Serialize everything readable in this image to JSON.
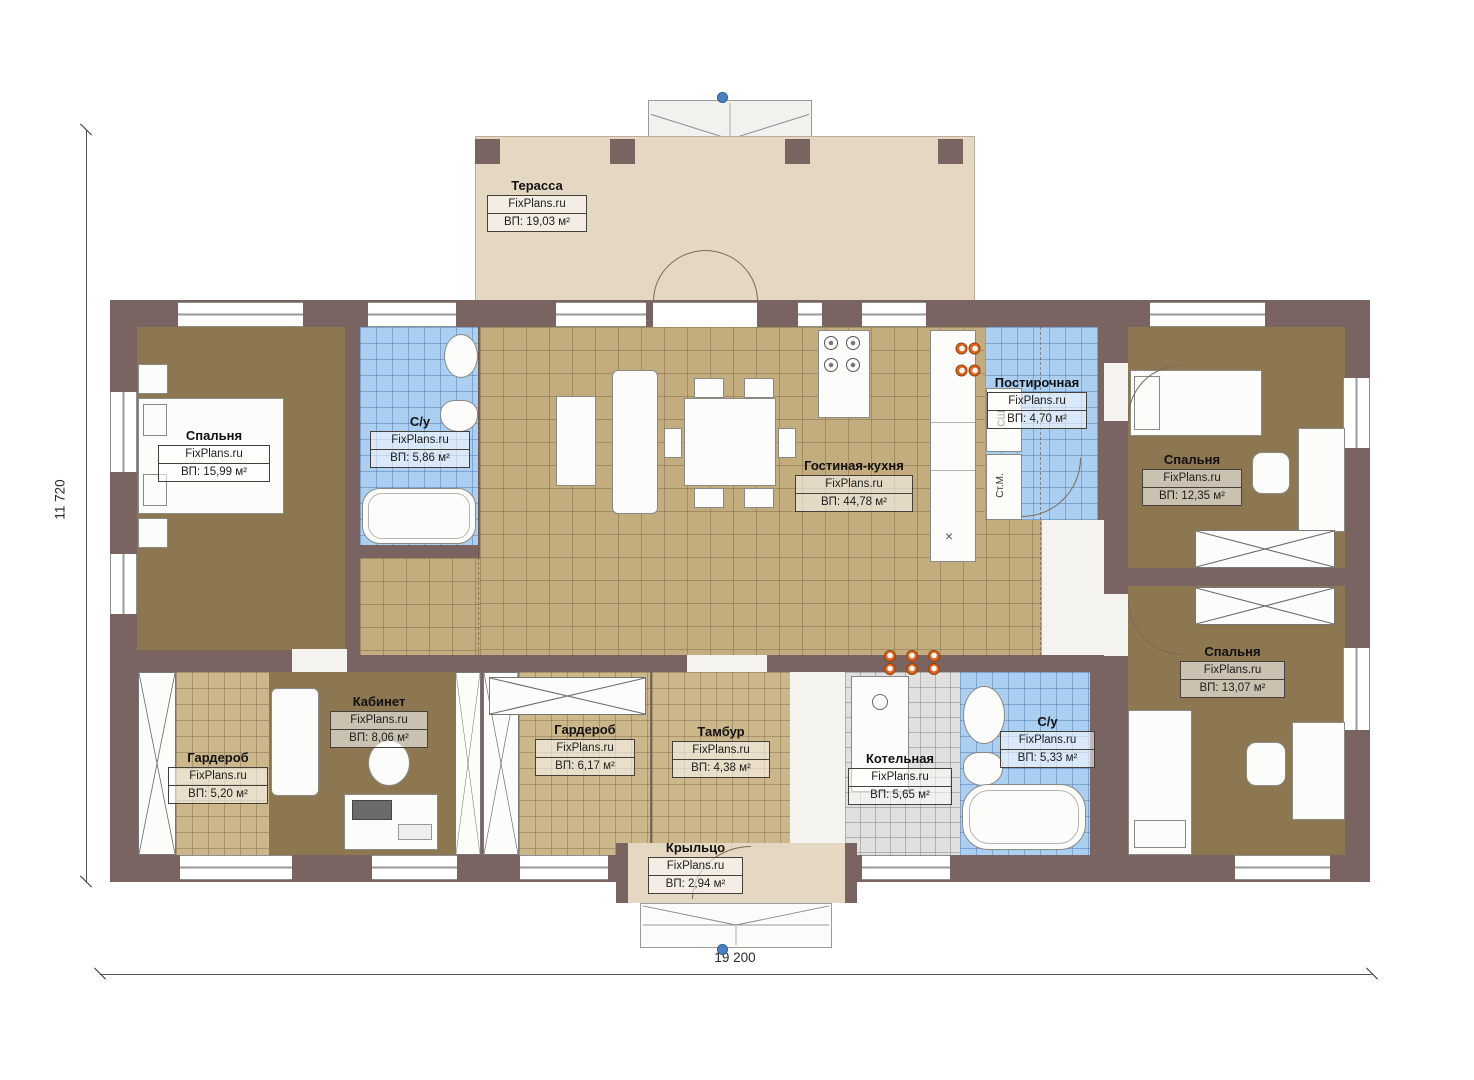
{
  "watermark": "FixPlans.ru",
  "dimensions": {
    "width_label": "19 200",
    "height_label": "11 720"
  },
  "rooms": {
    "terrace": {
      "name": "Терасса",
      "area": "ВП: 19,03 м²"
    },
    "bedroom_left": {
      "name": "Спальня",
      "area": "ВП: 15,99 м²"
    },
    "bathroom_top": {
      "name": "С/у",
      "area": "ВП: 5,86 м²"
    },
    "living_kitchen": {
      "name": "Гостиная-кухня",
      "area": "ВП: 44,78 м²"
    },
    "laundry": {
      "name": "Постирочная",
      "area": "ВП: 4,70 м²"
    },
    "bedroom_top_right": {
      "name": "Спальня",
      "area": "ВП: 12,35 м²"
    },
    "bedroom_bottom_right": {
      "name": "Спальня",
      "area": "ВП: 13,07 м²"
    },
    "wardrobe_left": {
      "name": "Гардероб",
      "area": "ВП: 5,20 м²"
    },
    "office": {
      "name": "Кабинет",
      "area": "ВП: 8,06 м²"
    },
    "wardrobe_middle": {
      "name": "Гардероб",
      "area": "ВП: 6,17 м²"
    },
    "tambour": {
      "name": "Тамбур",
      "area": "ВП: 4,38 м²"
    },
    "boiler": {
      "name": "Котельная",
      "area": "ВП: 5,65 м²"
    },
    "bathroom_bottom": {
      "name": "С/у",
      "area": "ВП: 5,33 м²"
    },
    "porch": {
      "name": "Крыльцо",
      "area": "ВП: 2,94 м²"
    }
  },
  "appliances": {
    "dryer_label": "СШ",
    "washer_label": "Ст.М.",
    "sink_mark": "×"
  },
  "colors": {
    "wall": "#7a6462",
    "bedroom_floor": "#8c7750",
    "living_tile": "#c3ac7e",
    "wet_tile": "#abcff1",
    "boiler_tile": "#e0e0de",
    "wardrobe_tile": "#ccb78a",
    "terrace": "#e4d8c3",
    "marker_orange": "#e2641e",
    "marker_blue": "#4a7fc1"
  }
}
